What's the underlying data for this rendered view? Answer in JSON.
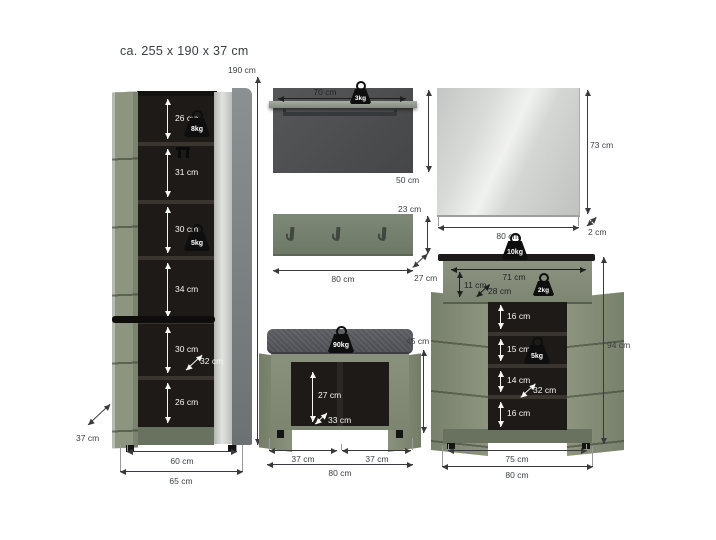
{
  "title": "ca. 255 x 190 x 37 cm",
  "colors": {
    "green": "#8A917E",
    "green_dark": "#69725F",
    "interior": "#1D1A17",
    "panel_gray": "#4E4F50",
    "dimension_line": "#3A3A3E",
    "weight_black": "#0E0E0E"
  },
  "tall_cabinet": {
    "height": "190 cm",
    "sections": [
      "26 cm",
      "31 cm",
      "30 cm",
      "34 cm",
      "30 cm",
      "26 cm"
    ],
    "top_load": "8kg",
    "shelf_load": "5kg",
    "inner_depth": "32 cm",
    "depth": "37 cm",
    "inner_width": "60 cm",
    "outer_width": "65 cm"
  },
  "wall_panel": {
    "width": "70 cm",
    "max_load": "3kg",
    "height": "50 cm"
  },
  "coat_rack": {
    "height": "23 cm",
    "width": "80 cm",
    "depth": "27 cm"
  },
  "mirror": {
    "height": "73 cm",
    "depth": "2 cm",
    "width": "80 cm"
  },
  "bench": {
    "max_load": "90kg",
    "height": "45 cm",
    "inner_height": "27 cm",
    "inner_depth": "33 cm",
    "left_width": "37 cm",
    "right_width": "37 cm",
    "width": "80 cm"
  },
  "shoe_cabinet": {
    "max_load": "10kg",
    "drawer_width": "71 cm",
    "drawer_height": "11 cm",
    "drawer_depth": "28 cm",
    "drawer_load": "2kg",
    "sections": [
      "16 cm",
      "15 cm",
      "14 cm",
      "16 cm"
    ],
    "shelf_load": "5kg",
    "inner_depth": "32 cm",
    "height": "94 cm",
    "inner_width": "75 cm",
    "outer_width": "80 cm"
  }
}
